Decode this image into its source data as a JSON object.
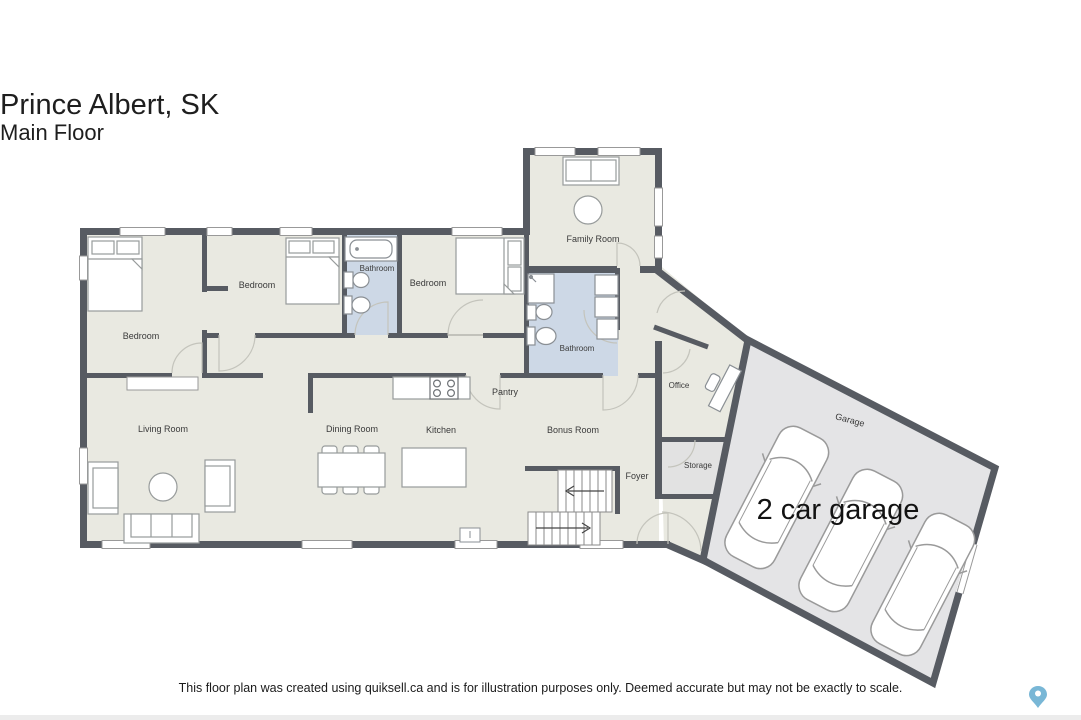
{
  "title": {
    "city": "Prince Albert, SK",
    "floor": "Main Floor"
  },
  "rooms": {
    "bedroom_left": "Bedroom",
    "bedroom_middle": "Bedroom",
    "bedroom_right": "Bedroom",
    "bathroom_top": "Bathroom",
    "bathroom_main": "Bathroom",
    "family_room": "Family Room",
    "living_room": "Living Room",
    "dining_room": "Dining Room",
    "kitchen": "Kitchen",
    "pantry": "Pantry",
    "bonus_room": "Bonus Room",
    "office": "Office",
    "storage": "Storage",
    "foyer": "Foyer",
    "garage": "Garage"
  },
  "annotations": {
    "garage_caption": "2 car garage"
  },
  "footer": {
    "disclaimer": "This floor plan was created using quiksell.ca and is for illustration purposes only. Deemed accurate but may not be exactly to scale."
  },
  "icons": {
    "map_pin": "teardrop-location-marker"
  },
  "colors": {
    "wall": "#575b62",
    "room_fill": "#e9e9e1",
    "bathroom_fill": "#cdd8e6",
    "storage_fill": "#e2e2e2",
    "garage_fill": "#e4e4e6",
    "label_text": "#3a3a3a",
    "pin_blue": "#79b7d6"
  }
}
